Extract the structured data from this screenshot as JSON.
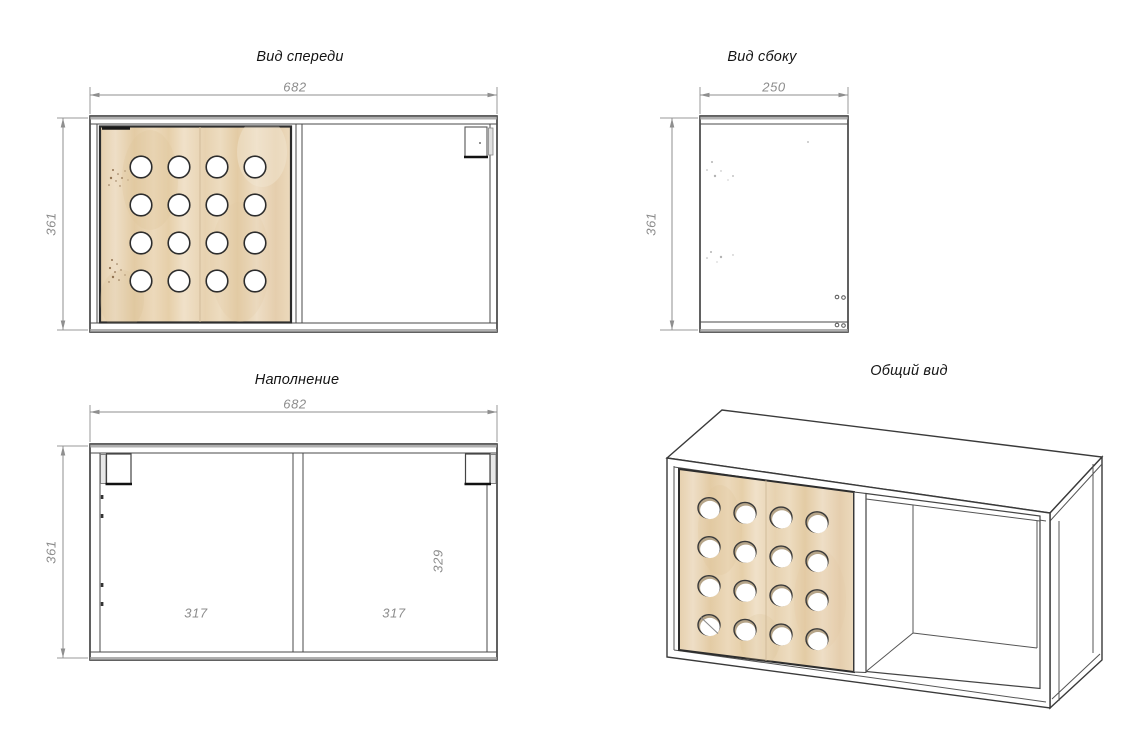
{
  "drawing": {
    "views": {
      "front": {
        "title": "Вид спереди",
        "dim_width": "682",
        "dim_height": "361"
      },
      "side": {
        "title": "Вид сбоку",
        "dim_depth": "250",
        "dim_height": "361"
      },
      "filling": {
        "title": "Наполнение",
        "dim_width": "682",
        "dim_height": "361",
        "dim_left_compartment": "317",
        "dim_right_compartment": "317",
        "dim_inner_height": "329"
      },
      "overall": {
        "title": "Общий вид"
      }
    },
    "colors": {
      "background": "#ffffff",
      "outline": "#3a3a3a",
      "dimension_gray": "#8c8c8c",
      "wood": "#e7d3b3"
    }
  }
}
